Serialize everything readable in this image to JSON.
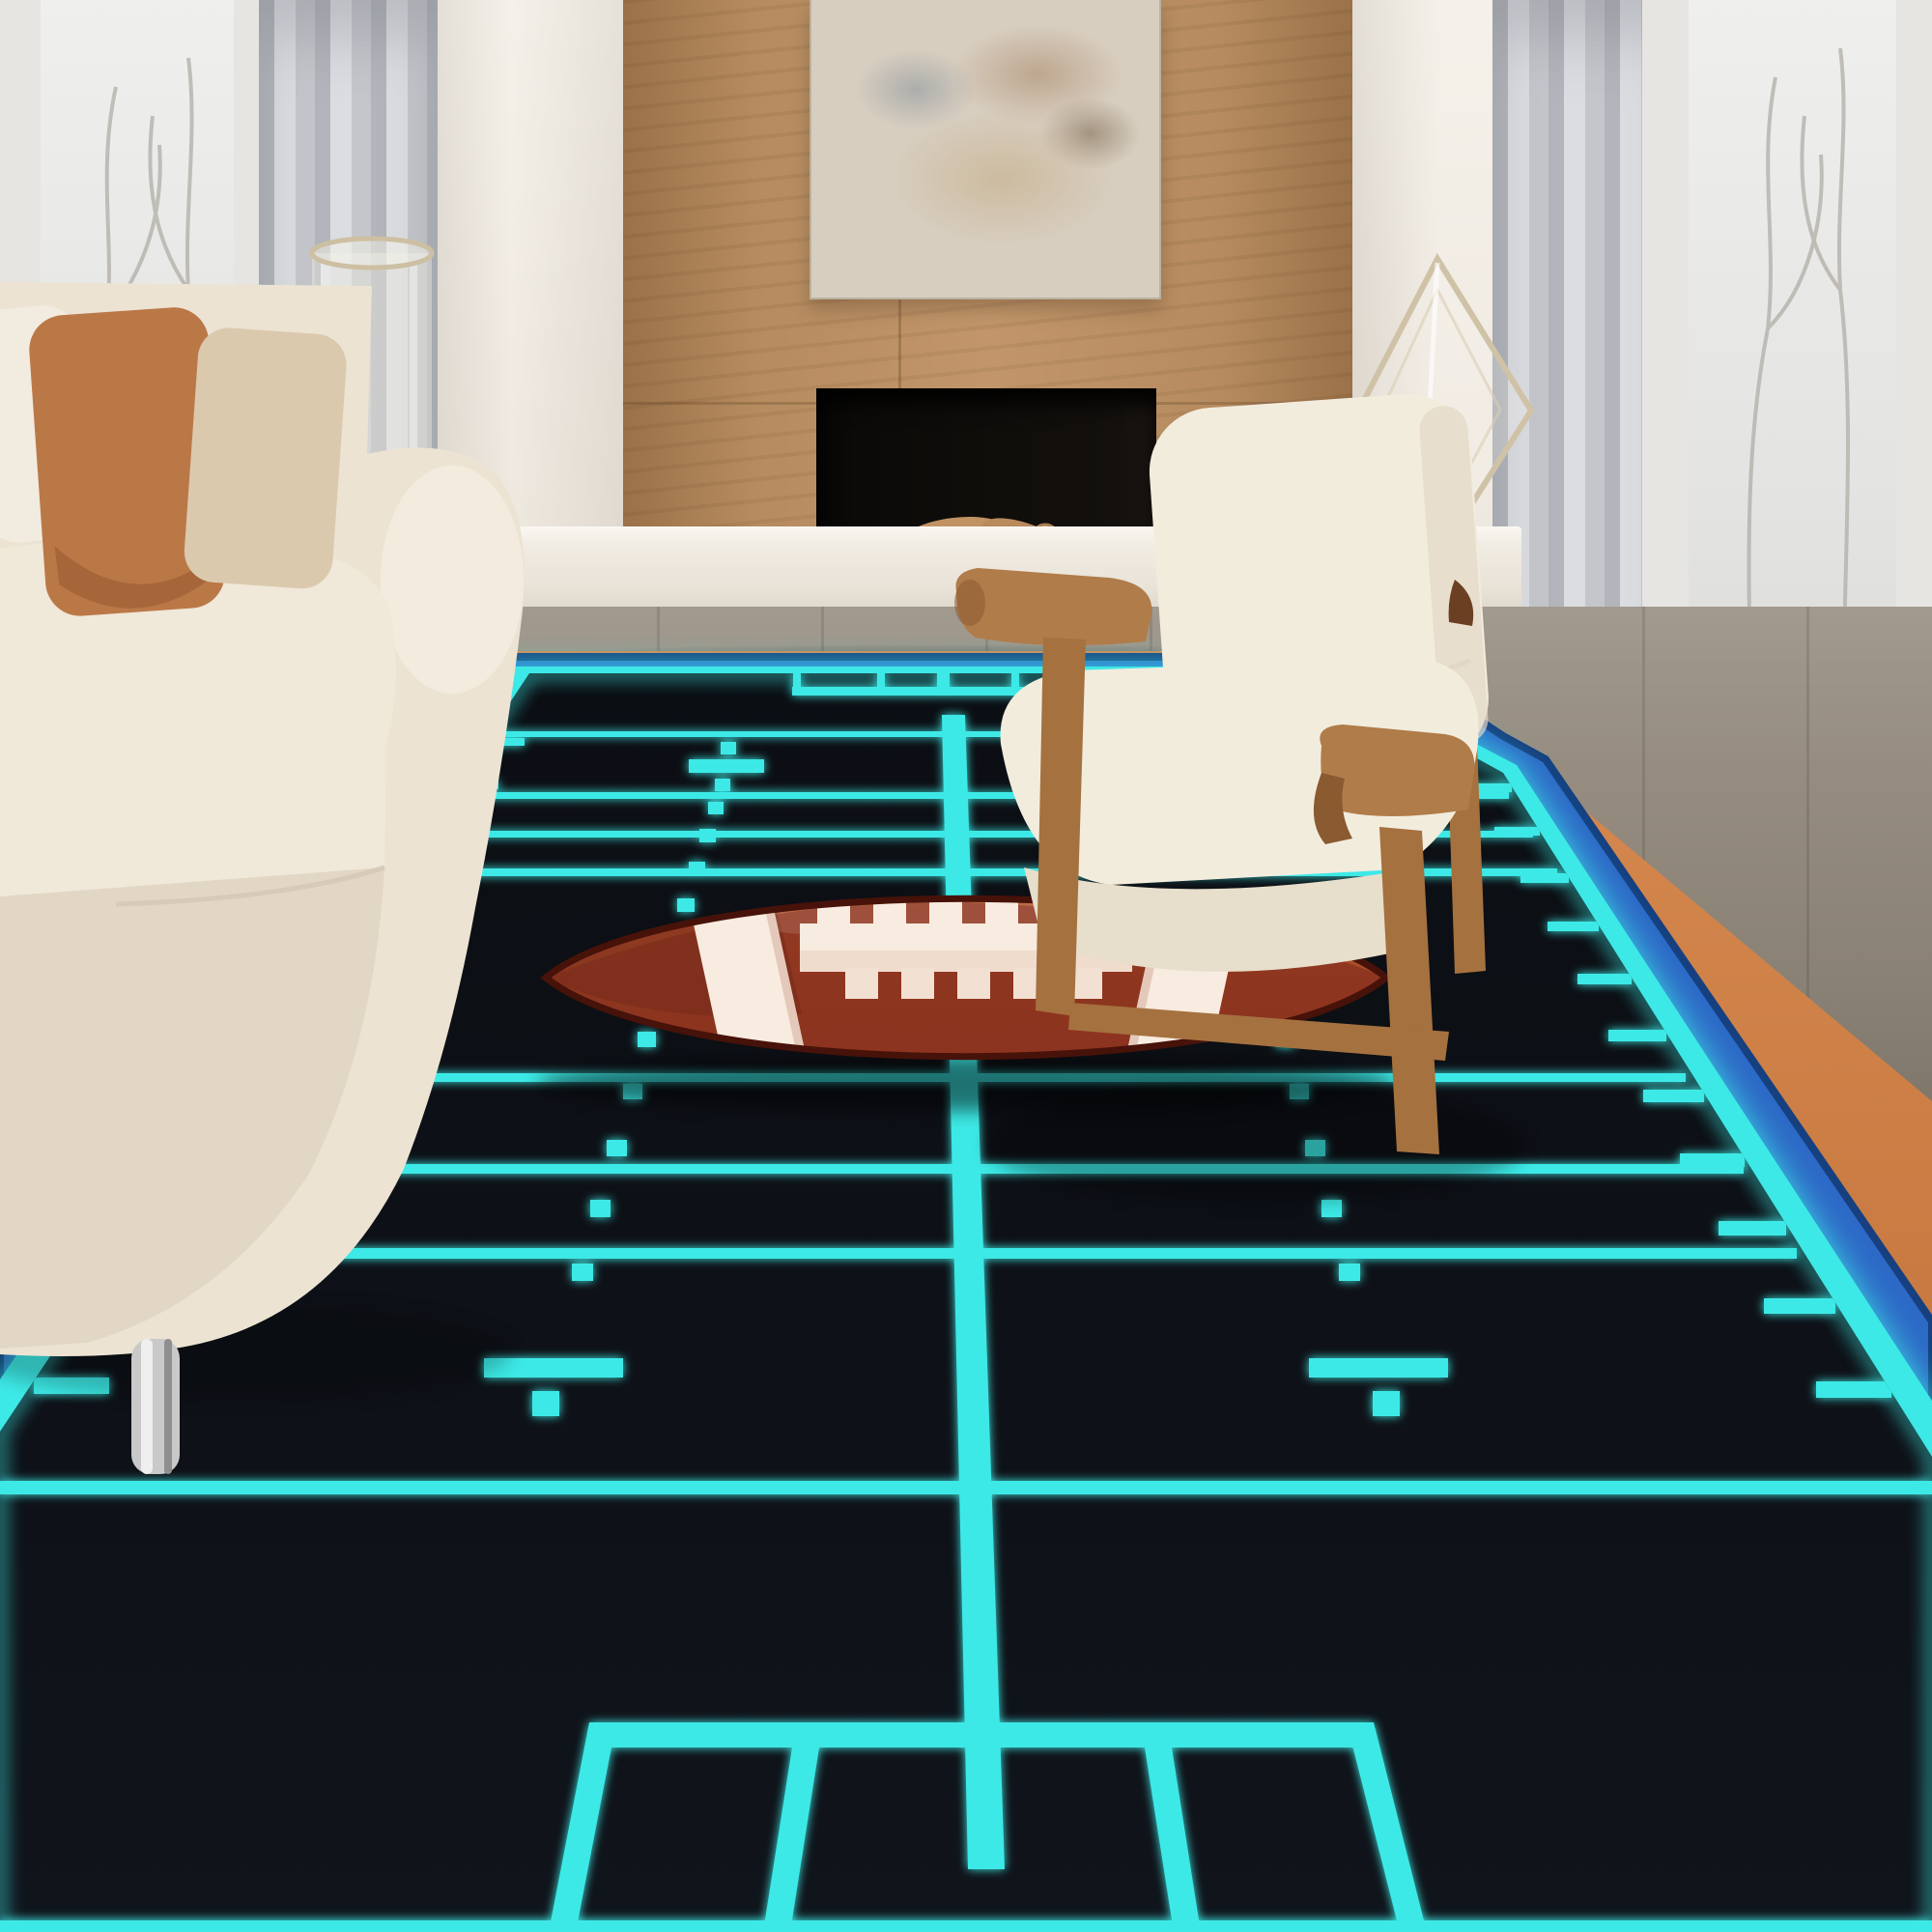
{
  "scene": {
    "description": "Modern living room product photo: glowing neon football-field area rug with cartoon football, fireplace, sofa and armchair",
    "objects": [
      "left window with winter trees",
      "left grey curtain",
      "cream wall",
      "wood fireplace surround",
      "abstract artwork",
      "firebox with stacked logs",
      "white floating hearth bench",
      "glass hurricane vase",
      "glass kite sculpture",
      "right grey curtain",
      "right window",
      "cream fabric sofa with pillows",
      "wood frame armchair with cream cushions",
      "grey wood floor",
      "black football field rug with neon cyan yard lines, blue and orange border",
      "cartoon brown football with white stripes and laces"
    ]
  },
  "colors": {
    "wall": "#f1ece4",
    "wood": "#b68b5f",
    "woodDark": "#9a7148",
    "art": "#d8cec0",
    "firebox": "#0c0a08",
    "pebbles": "#272320",
    "bench": "#f1ece3",
    "benchFace": "#e9e3d8",
    "floor": "#968c80",
    "floorDark": "#7c7367",
    "glass": "#e3e3e1",
    "frame": "#e7e5e1",
    "sash": "#565b61",
    "curtain": "#c4c6cb",
    "curtainDark": "#b2b5bb",
    "curtainLight": "#dbdde1",
    "rugBlack": "#0d1016",
    "rugCyan": "#3de9e6",
    "rugBlue": "#2d69c6",
    "rugNavy": "#16407f",
    "rugOrange": "#ca7c42",
    "rugOrangeDeep": "#b96a33",
    "ballLight": "#b75730",
    "ballDark": "#8c3420",
    "ballDeep": "#772c1a",
    "ballOutline": "#471209",
    "ballWhite": "#f8ebdf",
    "sofa": "#ece3d3",
    "sofaShade": "#e2d7c5",
    "sofaDeep": "#d7cab7",
    "pillowRust": "#bb7847",
    "pillowRustDark": "#9a5a30",
    "pillowBeige": "#dbc9ae",
    "pillowWhite": "#f1ebe0",
    "chairCream": "#f2ecdd",
    "chairWood": "#b07c49",
    "chairWoodDark": "#8a5a31",
    "chairWoodMid": "#a5713f",
    "chrome": "#c9c9c9",
    "glassEdge": "#cfc2a6"
  }
}
